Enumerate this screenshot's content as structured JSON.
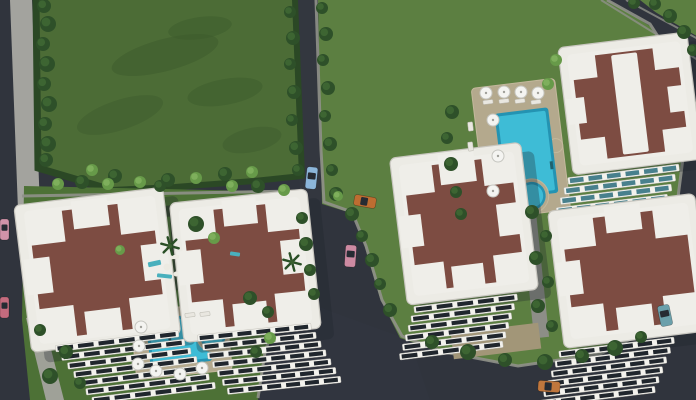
{
  "meta": {
    "type": "3d-aerial-architectural-render",
    "subject": "Bird's-eye 3D rendering of a residential apartment complex: five white apartment blocks with brown cross-patterned roofs, two swimming pools with umbrellas, lawns, an empty green field, asphalt roads and parked cars",
    "width": 696,
    "height": 400
  },
  "colors": {
    "road": "#30343d",
    "roadLight": "#3a3e48",
    "sidewalk": "#a3a39e",
    "curb": "#90918a",
    "field": "#4c6c36",
    "fieldDark": "#3c5a2c",
    "lawn": "#5c7f41",
    "courtyard": "#4d7136",
    "hedge": "#2b4825",
    "bushDark": "#2e5029",
    "bushDarkHi": "#3f6834",
    "bushLight": "#679a49",
    "bushLightHi": "#82b35f",
    "roof": "#7d4c42",
    "roofWhite": "#efeee9",
    "building": "#ecebe5",
    "buildingEdge": "#c9c7c0",
    "facadeRow": "#f3f2ed",
    "window": "#20262d",
    "glassTeal": "#48808d",
    "deck": "#b4a98d",
    "plaza": "#a29678",
    "walkway": "#8d8e87",
    "pathDark": "#33402d",
    "pool": "#3ebcd6",
    "poolDeep": "#2493b2",
    "umbrella": "#f4f4f1",
    "umbrellaEdge": "#c6c6c0",
    "shadow": "#1f232b"
  },
  "scene": {
    "trees": {
      "dark": [
        [
          44,
          6,
          7
        ],
        [
          48,
          24,
          8
        ],
        [
          43,
          44,
          7
        ],
        [
          47,
          64,
          8
        ],
        [
          44,
          84,
          7
        ],
        [
          49,
          104,
          8
        ],
        [
          45,
          124,
          7
        ],
        [
          48,
          144,
          8
        ],
        [
          46,
          160,
          7
        ],
        [
          115,
          176,
          7
        ],
        [
          168,
          180,
          7
        ],
        [
          225,
          174,
          7
        ],
        [
          290,
          12,
          6
        ],
        [
          293,
          38,
          7
        ],
        [
          290,
          64,
          6
        ],
        [
          294,
          92,
          7
        ],
        [
          292,
          120,
          6
        ],
        [
          296,
          148,
          7
        ],
        [
          298,
          170,
          6
        ],
        [
          322,
          8,
          6
        ],
        [
          326,
          34,
          7
        ],
        [
          323,
          60,
          6
        ],
        [
          328,
          88,
          7
        ],
        [
          325,
          116,
          6
        ],
        [
          330,
          144,
          7
        ],
        [
          332,
          170,
          6
        ],
        [
          336,
          194,
          7
        ],
        [
          352,
          214,
          7
        ],
        [
          362,
          236,
          6
        ],
        [
          372,
          260,
          7
        ],
        [
          380,
          284,
          6
        ],
        [
          390,
          310,
          7
        ],
        [
          452,
          112,
          7
        ],
        [
          447,
          138,
          6
        ],
        [
          451,
          164,
          7
        ],
        [
          456,
          192,
          6
        ],
        [
          461,
          214,
          6
        ],
        [
          532,
          212,
          7
        ],
        [
          546,
          236,
          6
        ],
        [
          536,
          258,
          7
        ],
        [
          548,
          282,
          6
        ],
        [
          538,
          306,
          7
        ],
        [
          552,
          326,
          6
        ],
        [
          432,
          342,
          7
        ],
        [
          468,
          352,
          8
        ],
        [
          505,
          360,
          7
        ],
        [
          545,
          362,
          8
        ],
        [
          582,
          356,
          7
        ],
        [
          615,
          348,
          8
        ],
        [
          641,
          337,
          6
        ],
        [
          655,
          4,
          6
        ],
        [
          670,
          16,
          7
        ],
        [
          684,
          32,
          7
        ],
        [
          693,
          50,
          6
        ],
        [
          634,
          3,
          6
        ],
        [
          82,
          182,
          7
        ],
        [
          160,
          186,
          6
        ],
        [
          258,
          186,
          7
        ],
        [
          302,
          218,
          6
        ],
        [
          306,
          244,
          7
        ],
        [
          310,
          270,
          6
        ],
        [
          314,
          294,
          6
        ],
        [
          196,
          224,
          8
        ],
        [
          250,
          298,
          7
        ],
        [
          268,
          312,
          6
        ],
        [
          66,
          352,
          7
        ],
        [
          50,
          376,
          8
        ],
        [
          80,
          383,
          6
        ],
        [
          40,
          330,
          6
        ],
        [
          256,
          352,
          6
        ]
      ],
      "light": [
        [
          92,
          170,
          6
        ],
        [
          140,
          182,
          6
        ],
        [
          196,
          178,
          6
        ],
        [
          252,
          172,
          6
        ],
        [
          58,
          184,
          6
        ],
        [
          108,
          184,
          6
        ],
        [
          232,
          186,
          6
        ],
        [
          284,
          190,
          6
        ],
        [
          214,
          238,
          6
        ],
        [
          120,
          250,
          5
        ],
        [
          556,
          60,
          6
        ],
        [
          548,
          84,
          6
        ],
        [
          270,
          338,
          6
        ],
        [
          338,
          196,
          5
        ]
      ]
    },
    "palms": [
      [
        170,
        246
      ],
      [
        292,
        262
      ]
    ],
    "umbrellas": [
      [
        486,
        93
      ],
      [
        504,
        92
      ],
      [
        521,
        92
      ],
      [
        538,
        93
      ],
      [
        493,
        120
      ],
      [
        498,
        156
      ],
      [
        493,
        191
      ],
      [
        141,
        327
      ],
      [
        139,
        346
      ],
      [
        138,
        364
      ],
      [
        156,
        371
      ],
      [
        180,
        374
      ],
      [
        202,
        368
      ]
    ],
    "loungers": [
      [
        483,
        100,
        10,
        4,
        -7
      ],
      [
        499,
        99,
        10,
        4,
        -7
      ],
      [
        515,
        99,
        10,
        4,
        -7
      ],
      [
        531,
        100,
        10,
        4,
        -7
      ],
      [
        468,
        122,
        5,
        9,
        -7
      ],
      [
        468,
        142,
        5,
        9,
        -7
      ],
      [
        185,
        313,
        10,
        4,
        -6
      ],
      [
        200,
        312,
        10,
        4,
        -6
      ]
    ],
    "playground": [
      {
        "shape": "rect",
        "x": 148,
        "y": 261,
        "w": 13,
        "h": 5,
        "rot": -12,
        "color": "#49b0bd"
      },
      {
        "shape": "rect",
        "x": 157,
        "y": 274,
        "w": 15,
        "h": 4,
        "rot": 6,
        "color": "#49b0bd"
      },
      {
        "shape": "circle",
        "x": 167,
        "y": 267,
        "r": 3.5,
        "color": "#eceae2"
      },
      {
        "shape": "rect",
        "x": 170,
        "y": 255,
        "w": 9,
        "h": 4,
        "rot": -4,
        "color": "#eceae2"
      },
      {
        "shape": "circle",
        "x": 176,
        "y": 274,
        "r": 2.5,
        "color": "#eceae2"
      },
      {
        "shape": "rect",
        "x": 230,
        "y": 252,
        "w": 10,
        "h": 4,
        "rot": 8,
        "color": "#49b0bd"
      }
    ],
    "cars": [
      {
        "name": "car-blue",
        "x": 306,
        "y": 167,
        "w": 11,
        "h": 22,
        "rot": 6,
        "color": "#8cb6da"
      },
      {
        "name": "car-orange-mid",
        "x": 354,
        "y": 196,
        "w": 22,
        "h": 11,
        "rot": 10,
        "color": "#bd6d31"
      },
      {
        "name": "car-pink-mid",
        "x": 345,
        "y": 245,
        "w": 11,
        "h": 22,
        "rot": 4,
        "color": "#cd8aa2"
      },
      {
        "name": "car-pink-left-top",
        "x": 0,
        "y": 219,
        "w": 9,
        "h": 21,
        "rot": 0,
        "color": "#d093a9"
      },
      {
        "name": "car-red-left-bottom",
        "x": 0,
        "y": 297,
        "w": 9,
        "h": 21,
        "rot": 0,
        "color": "#c46b7e"
      },
      {
        "name": "car-teal-right",
        "x": 659,
        "y": 305,
        "w": 12,
        "h": 21,
        "rot": -12,
        "color": "#6ba0ab"
      },
      {
        "name": "car-orange-bottom",
        "x": 538,
        "y": 381,
        "w": 22,
        "h": 11,
        "rot": 4,
        "color": "#c0773d"
      }
    ],
    "facades": [
      {
        "parent": "b1",
        "x": 46,
        "y": 340,
        "rows": 7,
        "w": 124,
        "h": 6.5,
        "stepX": 5,
        "stepY": 9.3,
        "cols": 6,
        "glass": "window"
      },
      {
        "parent": "b2",
        "x": 190,
        "y": 330,
        "rows": 7,
        "w": 114,
        "h": 6.5,
        "stepX": 4,
        "stepY": 9.3,
        "cols": 6,
        "glass": "window"
      },
      {
        "parent": "b3",
        "x": 404,
        "y": 300,
        "rows": 6,
        "w": 104,
        "h": 6.5,
        "stepX": -4,
        "stepY": 9,
        "cols": 5,
        "glass": "window"
      },
      {
        "parent": "b4",
        "x": 560,
        "y": 170,
        "rows": 5,
        "w": 112,
        "h": 7,
        "stepX": -5,
        "stepY": 9.5,
        "cols": 6,
        "glass": "teal"
      },
      {
        "parent": "b5",
        "x": 552,
        "y": 342,
        "rows": 6,
        "w": 116,
        "h": 6.5,
        "stepX": -5,
        "stepY": 9.3,
        "cols": 6,
        "glass": "window"
      }
    ]
  }
}
